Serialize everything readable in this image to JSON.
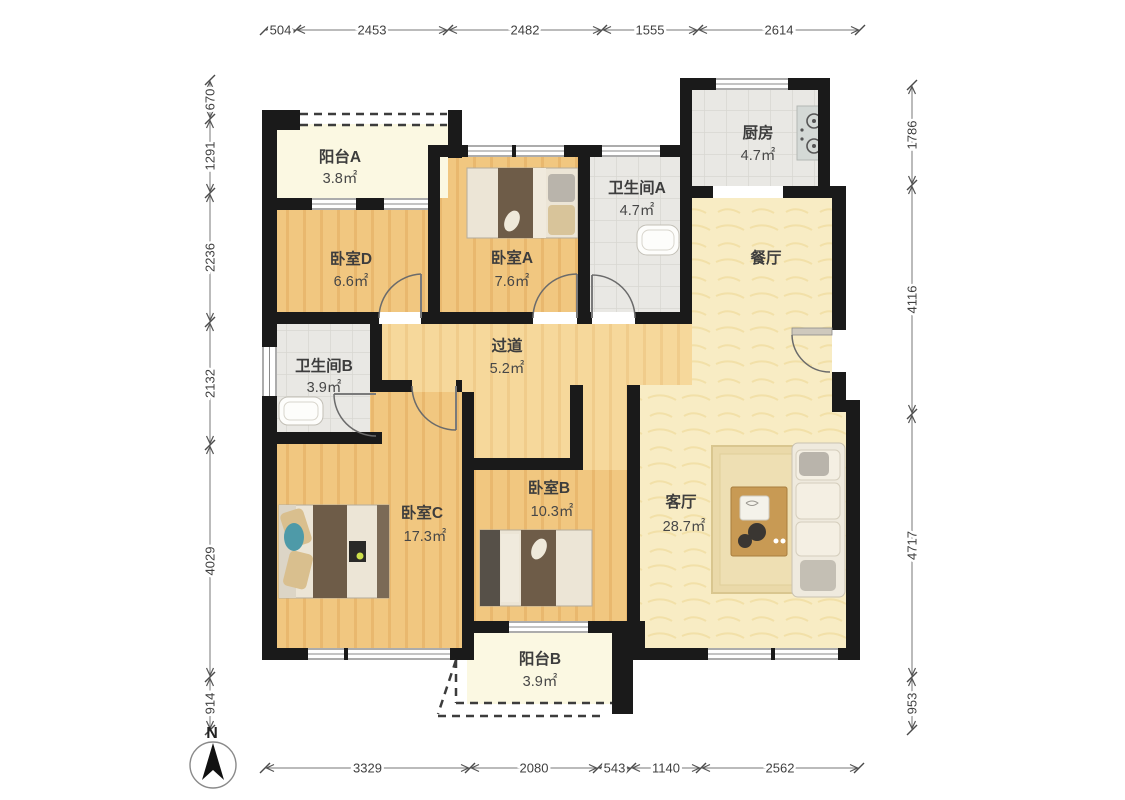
{
  "title": "apartment-floor-plan",
  "compass": {
    "label": "N"
  },
  "dimensions": {
    "top": [
      "504",
      "2453",
      "2482",
      "1555",
      "2614"
    ],
    "left": [
      "670",
      "1291",
      "2236",
      "2132",
      "4029",
      "914"
    ],
    "right": [
      "1786",
      "4116",
      "4717",
      "953"
    ],
    "bottom": [
      "3329",
      "2080",
      "543",
      "1140",
      "2562"
    ]
  },
  "rooms": {
    "balcony_a": {
      "name": "阳台A",
      "area": "3.8㎡"
    },
    "bedroom_d": {
      "name": "卧室D",
      "area": "6.6㎡"
    },
    "bedroom_a": {
      "name": "卧室A",
      "area": "7.6㎡"
    },
    "bathroom_a": {
      "name": "卫生间A",
      "area": "4.7㎡"
    },
    "kitchen": {
      "name": "厨房",
      "area": "4.7㎡"
    },
    "dining": {
      "name": "餐厅",
      "area": ""
    },
    "hallway": {
      "name": "过道",
      "area": "5.2㎡"
    },
    "bathroom_b": {
      "name": "卫生间B",
      "area": "3.9㎡"
    },
    "bedroom_c": {
      "name": "卧室C",
      "area": "17.3㎡"
    },
    "bedroom_b": {
      "name": "卧室B",
      "area": "10.3㎡"
    },
    "living": {
      "name": "客厅",
      "area": "28.7㎡"
    },
    "balcony_b": {
      "name": "阳台B",
      "area": "3.9㎡"
    }
  },
  "colors": {
    "wall": "#1a1a1a",
    "bedroom_floor": "#f1c780",
    "hallway_floor": "#f6d89b",
    "tile_floor": "#e9e8e4",
    "living_floor": "#f8ecc4",
    "balcony_floor": "#fbf8e2"
  }
}
